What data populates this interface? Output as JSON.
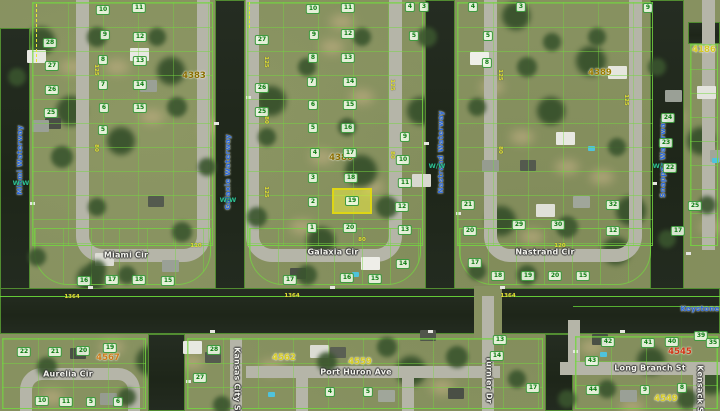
{
  "map": {
    "highlight": {
      "parcel_number": "19"
    },
    "waterway_labels": [
      {
        "text": "Miami Waterway",
        "x": 20,
        "y": 160,
        "rot": -90
      },
      {
        "text": "Galaxie Waterway",
        "x": 228,
        "y": 172,
        "rot": -90
      },
      {
        "text": "Nastrand Waterway",
        "x": 441,
        "y": 152,
        "rot": -90
      },
      {
        "text": "Snapper Waterway",
        "x": 663,
        "y": 158,
        "rot": -90
      },
      {
        "text": "Keystone",
        "x": 700,
        "y": 309,
        "rot": 0
      }
    ],
    "ww_markers": [
      {
        "text": "W/W",
        "x": 21,
        "y": 183
      },
      {
        "text": "W/W",
        "x": 228,
        "y": 200
      },
      {
        "text": "W/W",
        "x": 437,
        "y": 166
      },
      {
        "text": "W/W",
        "x": 661,
        "y": 166
      }
    ],
    "street_labels": [
      {
        "text": "Miami Cir",
        "x": 126,
        "y": 255,
        "rot": 0
      },
      {
        "text": "Galaxia Cir",
        "x": 333,
        "y": 252,
        "rot": 0
      },
      {
        "text": "Nastrand Cir",
        "x": 545,
        "y": 252,
        "rot": 0
      },
      {
        "text": "Aurelia Cir",
        "x": 68,
        "y": 374,
        "rot": 0
      },
      {
        "text": "Port Huron Ave",
        "x": 356,
        "y": 372,
        "rot": 0
      },
      {
        "text": "Long Branch St",
        "x": 650,
        "y": 368,
        "rot": 0
      },
      {
        "text": "Kansas City St",
        "x": 237,
        "y": 381,
        "rot": 90
      },
      {
        "text": "Turnier Dr",
        "x": 489,
        "y": 380,
        "rot": 90
      },
      {
        "text": "Kensack St",
        "x": 700,
        "y": 391,
        "rot": 90
      }
    ],
    "address_labels": [
      {
        "text": "4386",
        "x": 341,
        "y": 158,
        "color": "#8a6c00"
      },
      {
        "text": "4383",
        "x": 194,
        "y": 76,
        "color": "#8a6c00"
      },
      {
        "text": "4389",
        "x": 600,
        "y": 73,
        "color": "#9c7c00"
      },
      {
        "text": "4186",
        "x": 704,
        "y": 50,
        "color": "#d6ca20"
      },
      {
        "text": "4545",
        "x": 680,
        "y": 352,
        "color": "#d03214"
      },
      {
        "text": "4549",
        "x": 666,
        "y": 399,
        "color": "#d6ca20"
      },
      {
        "text": "4559",
        "x": 360,
        "y": 362,
        "color": "#d6ca20"
      },
      {
        "text": "4562",
        "x": 284,
        "y": 358,
        "color": "#d6ca20"
      },
      {
        "text": "4567",
        "x": 108,
        "y": 358,
        "color": "#cc7a1a"
      }
    ],
    "parcel_numbers": [
      {
        "n": "10",
        "x": 103,
        "y": 10
      },
      {
        "n": "11",
        "x": 139,
        "y": 8
      },
      {
        "n": "9",
        "x": 105,
        "y": 35
      },
      {
        "n": "12",
        "x": 140,
        "y": 37
      },
      {
        "n": "8",
        "x": 103,
        "y": 60
      },
      {
        "n": "13",
        "x": 140,
        "y": 61
      },
      {
        "n": "7",
        "x": 103,
        "y": 85
      },
      {
        "n": "14",
        "x": 140,
        "y": 85
      },
      {
        "n": "6",
        "x": 104,
        "y": 108
      },
      {
        "n": "15",
        "x": 140,
        "y": 108
      },
      {
        "n": "5",
        "x": 103,
        "y": 130
      },
      {
        "n": "28",
        "x": 50,
        "y": 43
      },
      {
        "n": "27",
        "x": 52,
        "y": 66
      },
      {
        "n": "26",
        "x": 52,
        "y": 90
      },
      {
        "n": "25",
        "x": 51,
        "y": 113
      },
      {
        "n": "16",
        "x": 84,
        "y": 281
      },
      {
        "n": "17",
        "x": 112,
        "y": 280
      },
      {
        "n": "18",
        "x": 139,
        "y": 280
      },
      {
        "n": "15",
        "x": 168,
        "y": 281
      },
      {
        "n": "27",
        "x": 262,
        "y": 40
      },
      {
        "n": "26",
        "x": 262,
        "y": 88
      },
      {
        "n": "25",
        "x": 262,
        "y": 112
      },
      {
        "n": "10",
        "x": 313,
        "y": 9
      },
      {
        "n": "11",
        "x": 348,
        "y": 8
      },
      {
        "n": "9",
        "x": 314,
        "y": 35
      },
      {
        "n": "12",
        "x": 348,
        "y": 34
      },
      {
        "n": "8",
        "x": 313,
        "y": 58
      },
      {
        "n": "13",
        "x": 348,
        "y": 58
      },
      {
        "n": "7",
        "x": 312,
        "y": 82
      },
      {
        "n": "14",
        "x": 350,
        "y": 82
      },
      {
        "n": "6",
        "x": 313,
        "y": 105
      },
      {
        "n": "15",
        "x": 350,
        "y": 105
      },
      {
        "n": "5",
        "x": 313,
        "y": 128
      },
      {
        "n": "16",
        "x": 348,
        "y": 128
      },
      {
        "n": "4",
        "x": 315,
        "y": 153
      },
      {
        "n": "17",
        "x": 350,
        "y": 153
      },
      {
        "n": "3",
        "x": 313,
        "y": 178
      },
      {
        "n": "18",
        "x": 351,
        "y": 178
      },
      {
        "n": "2",
        "x": 313,
        "y": 202
      },
      {
        "n": "1",
        "x": 312,
        "y": 228
      },
      {
        "n": "20",
        "x": 350,
        "y": 228
      },
      {
        "n": "4",
        "x": 410,
        "y": 7
      },
      {
        "n": "3",
        "x": 424,
        "y": 7
      },
      {
        "n": "5",
        "x": 414,
        "y": 36
      },
      {
        "n": "9",
        "x": 405,
        "y": 137
      },
      {
        "n": "10",
        "x": 403,
        "y": 160
      },
      {
        "n": "11",
        "x": 405,
        "y": 183
      },
      {
        "n": "12",
        "x": 402,
        "y": 207
      },
      {
        "n": "13",
        "x": 405,
        "y": 230
      },
      {
        "n": "17",
        "x": 290,
        "y": 280
      },
      {
        "n": "16",
        "x": 347,
        "y": 278
      },
      {
        "n": "15",
        "x": 375,
        "y": 279
      },
      {
        "n": "14",
        "x": 403,
        "y": 264
      },
      {
        "n": "4",
        "x": 473,
        "y": 7
      },
      {
        "n": "3",
        "x": 521,
        "y": 7
      },
      {
        "n": "5",
        "x": 488,
        "y": 36
      },
      {
        "n": "8",
        "x": 487,
        "y": 63
      },
      {
        "n": "21",
        "x": 468,
        "y": 205
      },
      {
        "n": "32",
        "x": 613,
        "y": 205
      },
      {
        "n": "20",
        "x": 470,
        "y": 231
      },
      {
        "n": "12",
        "x": 613,
        "y": 231
      },
      {
        "n": "29",
        "x": 519,
        "y": 225
      },
      {
        "n": "30",
        "x": 558,
        "y": 225
      },
      {
        "n": "17",
        "x": 475,
        "y": 263
      },
      {
        "n": "18",
        "x": 498,
        "y": 276
      },
      {
        "n": "19",
        "x": 528,
        "y": 276
      },
      {
        "n": "20",
        "x": 555,
        "y": 276
      },
      {
        "n": "15",
        "x": 583,
        "y": 276
      },
      {
        "n": "24",
        "x": 668,
        "y": 118
      },
      {
        "n": "23",
        "x": 666,
        "y": 143
      },
      {
        "n": "22",
        "x": 670,
        "y": 168
      },
      {
        "n": "25",
        "x": 695,
        "y": 206
      },
      {
        "n": "17",
        "x": 678,
        "y": 231
      },
      {
        "n": "9",
        "x": 648,
        "y": 8
      },
      {
        "n": "22",
        "x": 24,
        "y": 352
      },
      {
        "n": "21",
        "x": 55,
        "y": 352
      },
      {
        "n": "20",
        "x": 83,
        "y": 351
      },
      {
        "n": "19",
        "x": 110,
        "y": 348
      },
      {
        "n": "10",
        "x": 42,
        "y": 401
      },
      {
        "n": "11",
        "x": 66,
        "y": 402
      },
      {
        "n": "5",
        "x": 91,
        "y": 402
      },
      {
        "n": "6",
        "x": 118,
        "y": 402
      },
      {
        "n": "28",
        "x": 214,
        "y": 350
      },
      {
        "n": "27",
        "x": 200,
        "y": 378
      },
      {
        "n": "13",
        "x": 500,
        "y": 340
      },
      {
        "n": "14",
        "x": 497,
        "y": 356
      },
      {
        "n": "17",
        "x": 533,
        "y": 388
      },
      {
        "n": "4",
        "x": 330,
        "y": 392
      },
      {
        "n": "5",
        "x": 368,
        "y": 392
      },
      {
        "n": "42",
        "x": 608,
        "y": 342
      },
      {
        "n": "43",
        "x": 592,
        "y": 361
      },
      {
        "n": "41",
        "x": 648,
        "y": 343
      },
      {
        "n": "40",
        "x": 672,
        "y": 342
      },
      {
        "n": "39",
        "x": 701,
        "y": 336
      },
      {
        "n": "35",
        "x": 713,
        "y": 343
      },
      {
        "n": "44",
        "x": 593,
        "y": 390
      },
      {
        "n": "9",
        "x": 645,
        "y": 390
      },
      {
        "n": "8",
        "x": 682,
        "y": 388
      }
    ],
    "dimension_labels": [
      {
        "t": "1364",
        "x": 72,
        "y": 297,
        "r": 0
      },
      {
        "t": "1364",
        "x": 292,
        "y": 296,
        "r": 0
      },
      {
        "t": "1364",
        "x": 508,
        "y": 296,
        "r": 0
      },
      {
        "t": "125",
        "x": 266,
        "y": 62,
        "r": 90
      },
      {
        "t": "80",
        "x": 266,
        "y": 120,
        "r": 90
      },
      {
        "t": "125",
        "x": 266,
        "y": 192,
        "r": 90
      },
      {
        "t": "125",
        "x": 392,
        "y": 85,
        "r": 90
      },
      {
        "t": "80",
        "x": 392,
        "y": 155,
        "r": 90
      },
      {
        "t": "125",
        "x": 96,
        "y": 70,
        "r": 90
      },
      {
        "t": "80",
        "x": 96,
        "y": 148,
        "r": 90
      },
      {
        "t": "125",
        "x": 500,
        "y": 75,
        "r": 90
      },
      {
        "t": "80",
        "x": 500,
        "y": 150,
        "r": 90
      },
      {
        "t": "125",
        "x": 626,
        "y": 100,
        "r": 90
      },
      {
        "t": "110",
        "x": 196,
        "y": 246,
        "r": 0
      },
      {
        "t": "80",
        "x": 362,
        "y": 240,
        "r": 0
      },
      {
        "t": "120",
        "x": 560,
        "y": 246,
        "r": 0
      }
    ],
    "colors": {
      "water": "#212a20",
      "land": "#879160",
      "road": "#b5b5a8",
      "parcel_line": "#74d640",
      "highlight_fill": "#ecec46",
      "highlight_border": "#ded614",
      "waterway_text": "#2b66d9",
      "street_text": "#f4f4ee",
      "badge_text": "#0c7a12",
      "dimension_text": "#e4e432"
    }
  }
}
